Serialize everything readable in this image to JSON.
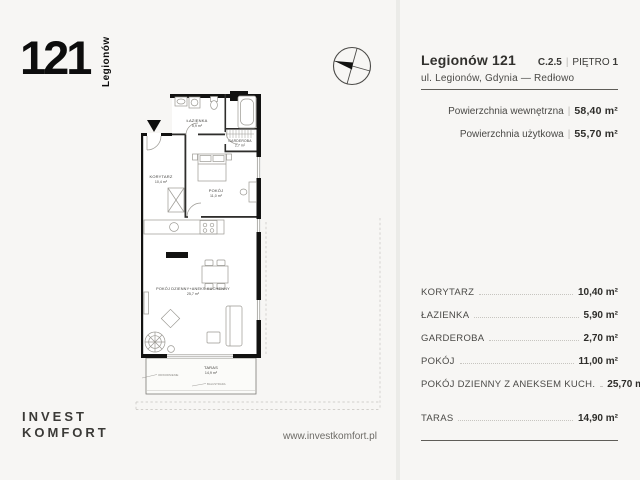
{
  "logo": {
    "number": "121",
    "vertical_text": "Legionów"
  },
  "header": {
    "title": "Legionów 121",
    "unit_code": "C.2.5",
    "separator": "|",
    "floor_label": "PIĘTRO",
    "floor_value": "1",
    "address": "ul. Legionów, Gdynia — Redłowo"
  },
  "areas": [
    {
      "label": "Powierzchnia wewnętrzna",
      "separator": "|",
      "value": "58,40 m²"
    },
    {
      "label": "Powierzchnia użytkowa",
      "separator": "|",
      "value": "55,70 m²"
    }
  ],
  "rooms": [
    {
      "label": "KORYTARZ",
      "value": "10,40 m²"
    },
    {
      "label": "ŁAZIENKA",
      "value": "5,90 m²"
    },
    {
      "label": "GARDEROBA",
      "value": "2,70 m²"
    },
    {
      "label": "POKÓJ",
      "value": "11,00 m²"
    },
    {
      "label": "POKÓJ DZIENNY Z ANEKSEM KUCH.",
      "value": "25,70 m²"
    }
  ],
  "taras": {
    "label": "TARAS",
    "value": "14,90 m²"
  },
  "footer": {
    "brand_line1": "INVEST",
    "brand_line2": "KOMFORT",
    "website": "www.investkomfort.pl"
  },
  "floorplan": {
    "rooms": [
      {
        "name": "ŁAZIENKA",
        "area": "5,9 m²"
      },
      {
        "name": "GARDEROBA",
        "area": "2,7 m²"
      },
      {
        "name": "KORYTARZ",
        "area": "10,4 m²"
      },
      {
        "name": "POKÓJ",
        "area": "11,0 m²"
      },
      {
        "name": "POKÓJ DZIENNY+ANEKS KUCHENNY",
        "area": "25,7 m²"
      },
      {
        "name": "TARAS",
        "area": "14,9 m²"
      }
    ],
    "annotations": [
      {
        "text": "ODWODNIENIE"
      },
      {
        "text": "BALUSTRADA"
      }
    ]
  },
  "colors": {
    "background": "#f7f6f4",
    "wall": "#121211",
    "text": "#3b3a37",
    "divider": "#ebebe8"
  }
}
